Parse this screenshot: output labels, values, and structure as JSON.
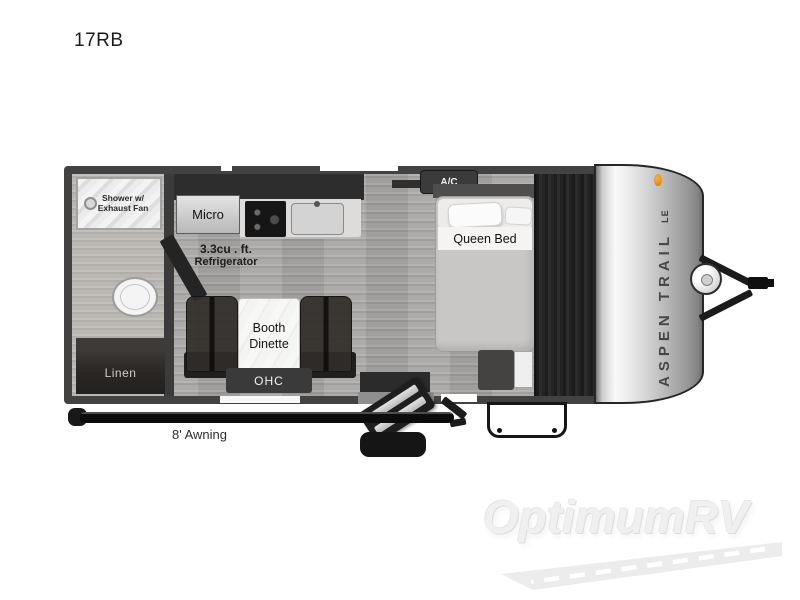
{
  "page": {
    "title": "17RB"
  },
  "floorplan": {
    "labels": {
      "shower_line1": "Shower w/",
      "shower_line2": "Exhaust Fan",
      "micro": "Micro",
      "fridge_line1": "3.3cu . ft.",
      "fridge_line2": "Refrigerator",
      "ac": "A/C",
      "queen_bed": "Queen Bed",
      "dinette_line1": "Booth",
      "dinette_line2": "Dinette",
      "ohc": "OHC",
      "linen": "Linen",
      "awning": "8' Awning"
    },
    "brand": {
      "name": "ASPEN TRAIL",
      "badge": "LE"
    },
    "colors": {
      "wall": "#424242",
      "floor": "#a8a6a4",
      "cap_silver": "#d6d6d6",
      "marker_light": "#ef9414",
      "watermark": "#f0f0f0"
    }
  },
  "watermark": {
    "text": "OptimumRV"
  }
}
